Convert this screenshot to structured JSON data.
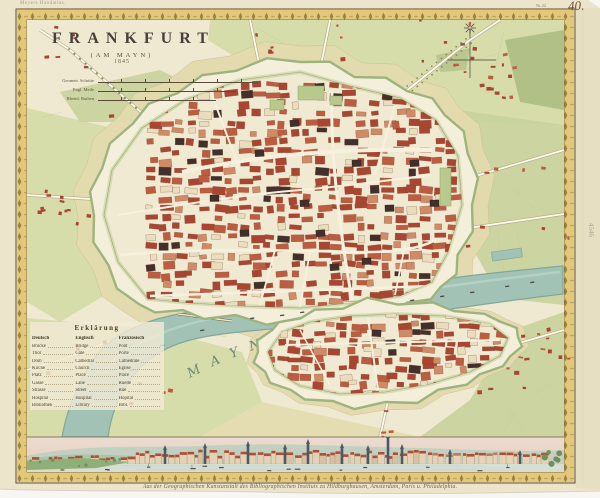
{
  "page": {
    "plate_number": "40.",
    "plate_small": "№ 42",
    "series_note": "Meyers Handatlas.",
    "pencil_note": "4546",
    "caption": "Aus der Geographischen Kunstanstalt des Bibliographischen Instituts zu Hildburghausen, Amsterdam, Paris u. Philadelphia."
  },
  "title": {
    "main": "FRANKFURT",
    "subtitle": "(AM MAYN)",
    "year": "1845"
  },
  "scale_bars": [
    {
      "label": "Geometr. Schritte"
    },
    {
      "label": "Engl. Meile"
    },
    {
      "label": "Rheinl. Ruthen"
    }
  ],
  "legend": {
    "title": "Erklärung",
    "columns": [
      "Deutsch",
      "Englisch",
      "Französisch"
    ],
    "rows": [
      [
        "Brücke",
        "Bridge",
        "Pont"
      ],
      [
        "Thor",
        "Gate",
        "Porte"
      ],
      [
        "Dom",
        "Cathedral",
        "Cathédrale"
      ],
      [
        "Kirche",
        "Church",
        "Église"
      ],
      [
        "Platz",
        "Place",
        "Place"
      ],
      [
        "Gasse",
        "Lane",
        "Ruelle"
      ],
      [
        "Strasse",
        "Street",
        "Rue"
      ],
      [
        "Hospital",
        "Hospital",
        "Hôpital"
      ],
      [
        "Bibliothek",
        "Library",
        "Bibl."
      ]
    ]
  },
  "map_labels": {
    "river": "MAYN FLUSS",
    "district_south": "SACHSENHAUSEN"
  },
  "colors": {
    "scan_bg": "#f7f6f2",
    "paper": "#ede5cb",
    "paper_edge": "#e0d6b8",
    "gold": "#e2c878",
    "gold_dark": "#8a7638",
    "frame_line": "#6f5c36",
    "map_cream": "#f0e9d1",
    "field_green": "#d4daa6",
    "field_green2": "#c8d19b",
    "forest": "#a8b97e",
    "glacis": "#e3dbae",
    "moat": "#9fb37e",
    "rampart": "#f4efdb",
    "city_fill": "#f1ead2",
    "outline_ink": "#8c7b5a",
    "red1": "#a84632",
    "red2": "#bc5d41",
    "salmon": "#cf8a66",
    "dark_bld": "#41302b",
    "cream_bld": "#e9ddbd",
    "street": "#f6f1de",
    "road_edge": "#b3a67f",
    "river": "#a3c2b6",
    "river_edge": "#7fa89a",
    "island": "#e4e3c2",
    "park": "#b7c98c",
    "sky_top": "#e9dcd2",
    "sky_low": "#edcdb6",
    "hill_far": "#bccfc0",
    "hill_near": "#a3bf9f",
    "pan_water": "#d6dfd4",
    "pan_wall": "#e6d3b6",
    "pan_roof": "#ad4f34",
    "spire": "#4c5a66",
    "boat": "#4f4a40",
    "ink": "#4a3f30",
    "ink_light": "#8c8474",
    "label_green": "#5d7a6c"
  }
}
